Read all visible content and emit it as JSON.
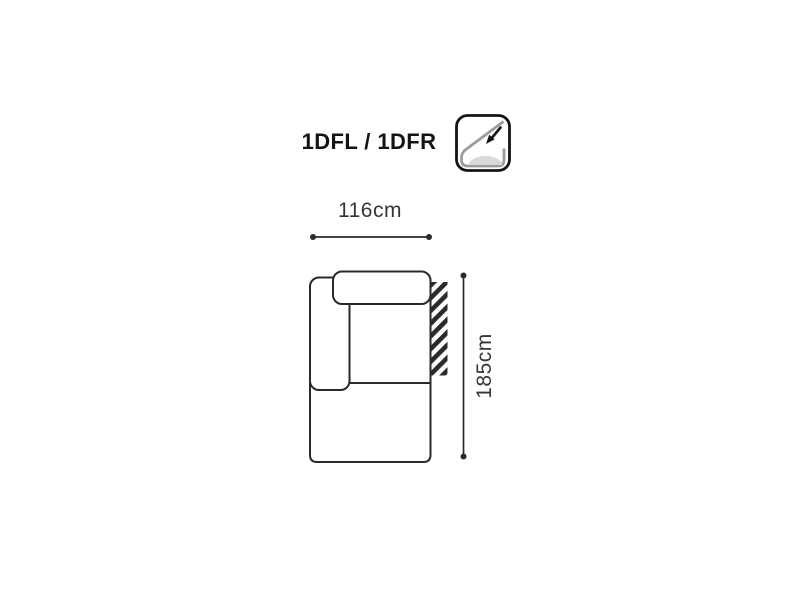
{
  "page": {
    "background": "#ffffff"
  },
  "header": {
    "title": "1DFL / 1DFR",
    "feature_icon": "recline-function-icon"
  },
  "dimensions": {
    "width_label": "116cm",
    "width_cm": 116,
    "height_label": "185cm",
    "height_cm": 185
  },
  "diagram": {
    "type": "sofa-module-top-view",
    "parts": [
      "armrest-left",
      "backrest",
      "seat",
      "ottoman-front",
      "connection-hatch-right"
    ]
  },
  "colors": {
    "line": "#2a2a2a",
    "dimension_text": "#363636",
    "title_text": "#141414",
    "icon_outline": "#141414",
    "icon_gray": "#9c9c9c",
    "icon_cushion": "#d9d9d9"
  }
}
